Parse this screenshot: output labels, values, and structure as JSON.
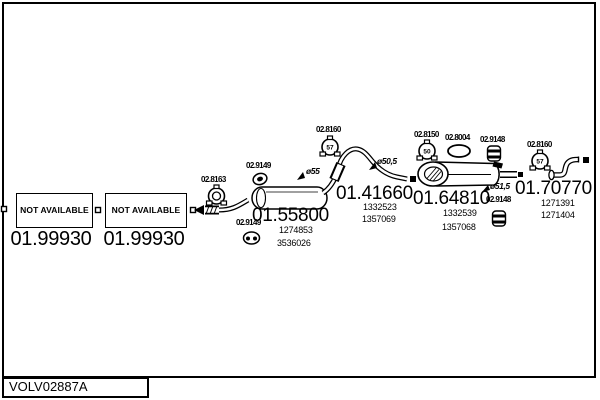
{
  "frame": {
    "doc_code": "VOLV02887A"
  },
  "colors": {
    "ink": "#000000",
    "paper": "#ffffff"
  },
  "na_boxes": [
    {
      "status": "NOT AVAILABLE",
      "part": "01.99930"
    },
    {
      "status": "NOT AVAILABLE",
      "part": "01.99930"
    }
  ],
  "parts": {
    "mid_muffler": {
      "number": "01.55800",
      "oem1": "1274853",
      "oem2": "3536026",
      "diameter": "ø55"
    },
    "mid_pipe": {
      "number": "01.41660",
      "oem1": "1332523",
      "oem2": "1357069",
      "diameter": "ø50,5"
    },
    "rear_muffler": {
      "number": "01.64810",
      "oem1": "1332539",
      "oem2": "1357068",
      "diameter": "ø51,5"
    },
    "tail_pipe": {
      "number": "01.70770",
      "oem1": "1271391",
      "oem2": "1271404"
    }
  },
  "fittings": {
    "clamp_8163": {
      "label": "02.8163",
      "icon": "clamp-ring-icon"
    },
    "grommet_9149_a": {
      "label": "02.9149",
      "icon": "rubber-grommet-icon"
    },
    "grommet_9149_b": {
      "label": "02.9149",
      "icon": "rubber-grommet-icon"
    },
    "clamp_8160_a": {
      "label": "02.8160",
      "size": "57",
      "icon": "clamp-icon"
    },
    "clamp_8150": {
      "label": "02.8150",
      "size": "50",
      "icon": "clamp-icon"
    },
    "gasket_8004": {
      "label": "02.8004",
      "icon": "oval-gasket-icon"
    },
    "hanger_9148_a": {
      "label": "02.9148",
      "icon": "rubber-hanger-icon"
    },
    "hanger_9148_b": {
      "label": "02.9148",
      "icon": "rubber-hanger-icon"
    },
    "clamp_8160_b": {
      "label": "02.8160",
      "size": "57",
      "icon": "clamp-icon"
    }
  }
}
